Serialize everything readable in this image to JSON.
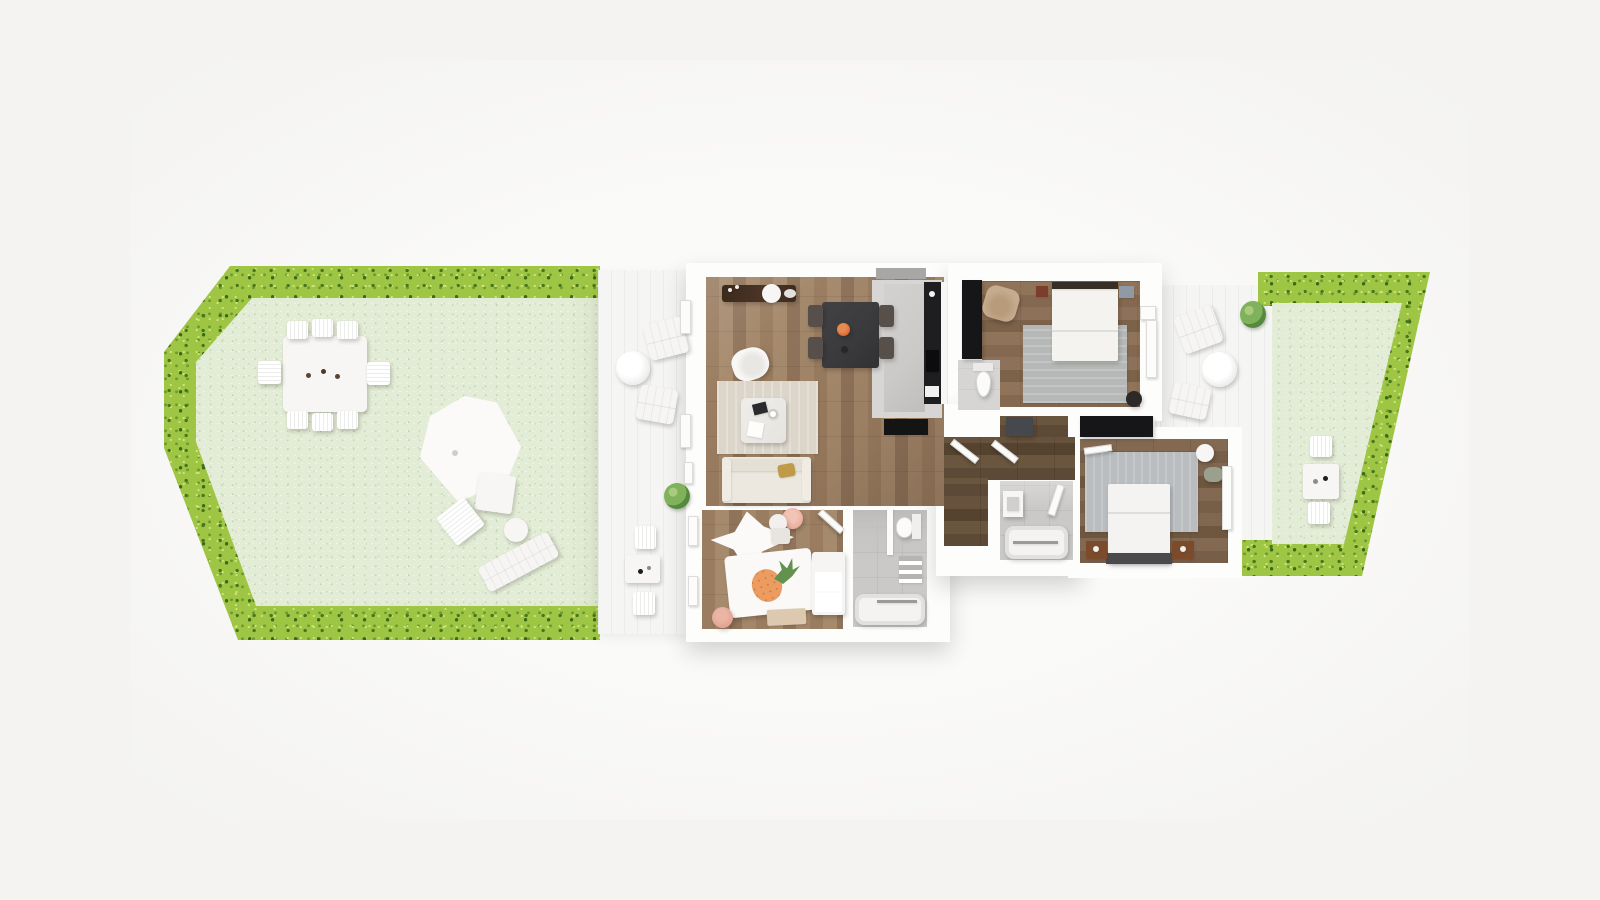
{
  "meta": {
    "scene": "3d-rendered-apartment-floor-plan-top-view",
    "visible_text": "none"
  },
  "palette": {
    "bg": "#f4f3f1",
    "canvas_halo": "#fafaf8",
    "wall": "#fdfdfc",
    "hedge": "#9fc544",
    "hedge_dark": "#49771f",
    "hedge_deep": "#3c6a19",
    "hedge_light": "#cce478",
    "lawn": "#e3ecd6",
    "deck": "#f5f5f3",
    "wood_living": "#a0846a",
    "wood_bed1": "#8a6e55",
    "wood_bed2": "#7e6450",
    "wood_hall": "#64503c",
    "tile": "#cac9c7",
    "tile_light": "#d6d5d3",
    "kitchen_floor": "#d7d6d4",
    "island": "#cbcac8",
    "counter_dark": "#1e1e20",
    "appliance_black": "#0c0c0e",
    "mat_black": "#141414",
    "rug_living": "#dbd5ca",
    "rug_bed1": "#b5b8b6",
    "rug_bed2": "#b9bdbf",
    "furn_white": "#f7f6f4",
    "sofa_cream": "#ece8df",
    "table_dark": "#3a3a3c",
    "chair_dark": "#57504a",
    "sideboard_walnut": "#4a3527",
    "tan_leather": "#c6ac8e",
    "mustard": "#bf9a48",
    "orange_bowl": "#d96a33",
    "pineapple": "#ec9c60",
    "leaf_green": "#63924f",
    "plant_green": "#7fb25a",
    "pink_pouf": "#e9af9f",
    "wardrobe_black": "#161619",
    "console_gray": "#45484c",
    "nightstand_brown": "#7b4b2c",
    "chrome": "#9a9a98",
    "basket_sage": "#9aa08e",
    "headboard_dark": "#372e26",
    "bedframe_dark": "#4a4a4c"
  },
  "areas": {
    "garden_left": {
      "label": "left garden with hedge border",
      "furniture": [
        "outdoor-dining-table",
        "eight-outdoor-chairs",
        "three-plates",
        "parasol",
        "parasol-side-seat",
        "garden-chair",
        "ottoman-ball",
        "sun-lounger"
      ]
    },
    "terrace_left": {
      "label": "left terrace deck",
      "furniture": [
        "two-loungers",
        "round-side-table",
        "potted-plant",
        "two-cube-seats",
        "coffee-table-with-two-cups"
      ]
    },
    "living_room": {
      "label": "open living / dining room",
      "furniture": [
        "walnut-sideboard",
        "serving-plate",
        "dining-table",
        "four-chairs",
        "fruit-bowl",
        "shell-armchair",
        "area-rug",
        "coffee-table",
        "notebook",
        "cup",
        "paper",
        "three-seat-sofa",
        "mustard-pillow"
      ]
    },
    "kitchen": {
      "label": "kitchen strip",
      "furniture": [
        "island-counter",
        "dark-counter-run",
        "sink",
        "black-appliance",
        "black-floor-mat",
        "high-window-band"
      ]
    },
    "wc": {
      "label": "guest toilet",
      "furniture": [
        "toilet"
      ]
    },
    "bedroom_1": {
      "label": "main bedroom top-right",
      "furniture": [
        "black-wardrobe",
        "double-bed",
        "two-nightstands",
        "area-rug",
        "tan-armchair",
        "black-pouf",
        "window-seat"
      ]
    },
    "hallway": {
      "label": "hallway",
      "furniture": [
        "dark-console",
        "four-open-door-leaves"
      ]
    },
    "bathroom_mid": {
      "label": "bathroom off hallway",
      "furniture": [
        "washbasin",
        "bathtub"
      ]
    },
    "kids_room": {
      "label": "kids room bottom-left",
      "furniture": [
        "teepee-tent",
        "pink-pouf",
        "white-ball",
        "mini-table",
        "pineapple-rug",
        "crib-bed",
        "bench",
        "second-pink-pouf"
      ]
    },
    "kids_bathroom": {
      "label": "bathroom bottom-center",
      "furniture": [
        "shower-divider",
        "toilet",
        "towel-shelf",
        "bathtub"
      ]
    },
    "bedroom_2": {
      "label": "bedroom bottom-right",
      "furniture": [
        "black-wardrobe",
        "double-bed",
        "two-brown-nightstands",
        "area-rug",
        "round-side-table",
        "laundry-basket",
        "window"
      ]
    },
    "terrace_right": {
      "label": "right terrace deck",
      "furniture": [
        "two-loungers",
        "round-table",
        "potted-plant"
      ]
    },
    "garden_right": {
      "label": "right garden with hedge border",
      "furniture": [
        "bistro-table-with-two-cups",
        "two-chairs"
      ]
    }
  }
}
